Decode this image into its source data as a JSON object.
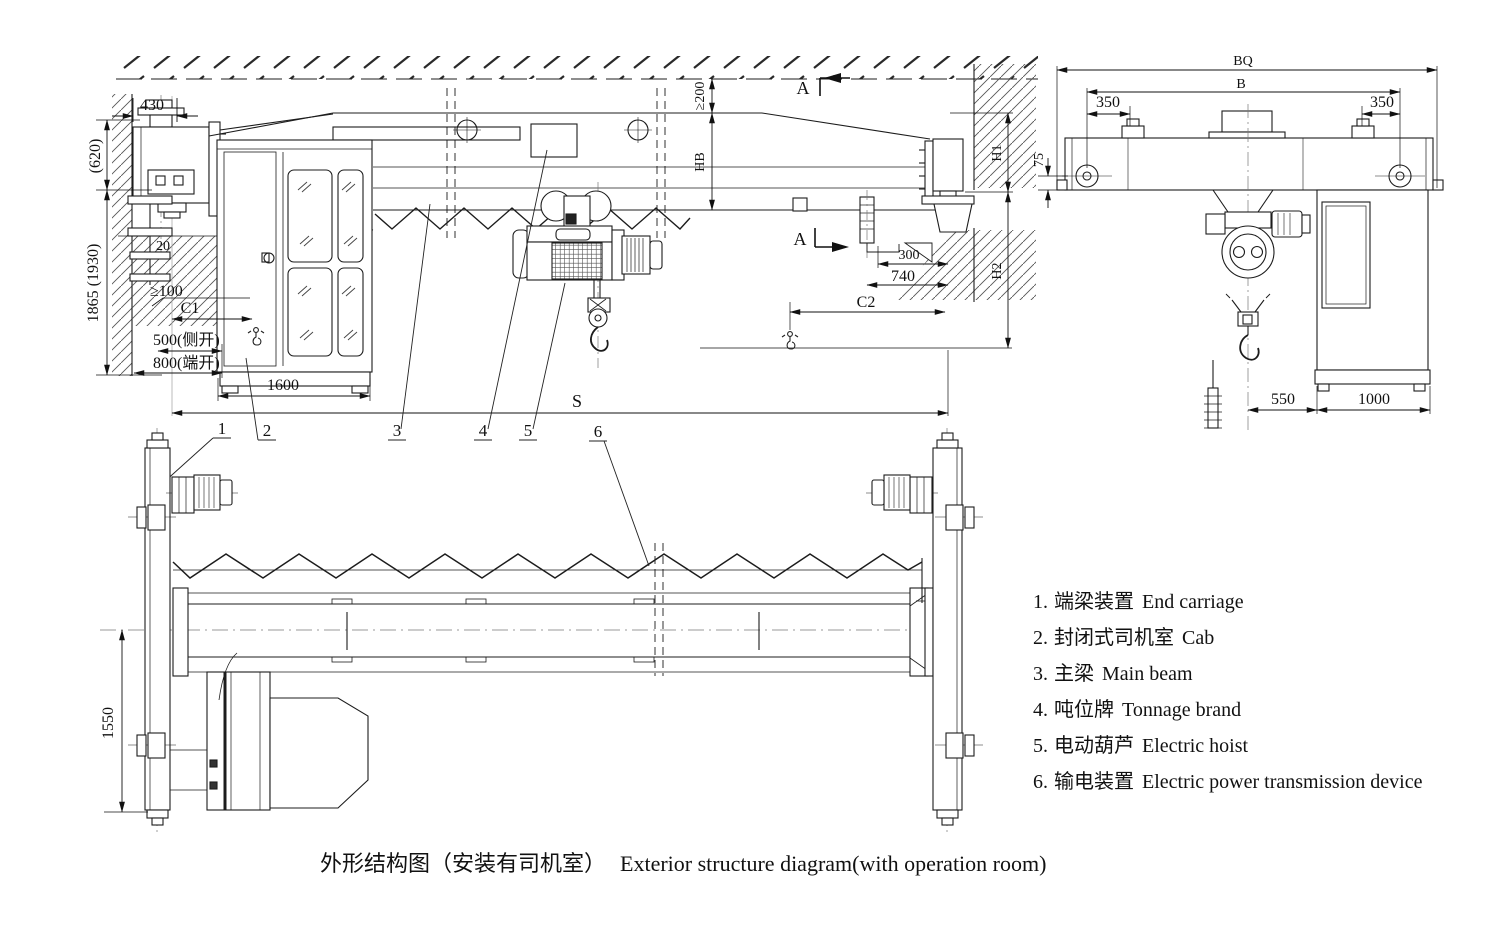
{
  "page": {
    "background": "#ffffff",
    "line_color": "#1c1c1c"
  },
  "caption": {
    "zh": "外形结构图（安装有司机室）",
    "en": "Exterior structure diagram(with operation room)"
  },
  "legend": {
    "items": [
      {
        "num": "1.",
        "zh": "端梁装置",
        "en": "End carriage"
      },
      {
        "num": "2.",
        "zh": "封闭式司机室",
        "en": "Cab"
      },
      {
        "num": "3.",
        "zh": "主梁",
        "en": "Main beam"
      },
      {
        "num": "4.",
        "zh": "吨位牌",
        "en": "Tonnage brand"
      },
      {
        "num": "5.",
        "zh": "电动葫芦",
        "en": "Electric hoist"
      },
      {
        "num": "6.",
        "zh": "输电装置",
        "en": "Electric power transmission device"
      }
    ]
  },
  "front_view": {
    "section_marker": "A",
    "dims": {
      "d430": "430",
      "d620": "(620)",
      "d1865": "1865 (1930)",
      "d20": "20",
      "ge100": "≥100",
      "c1": "C1",
      "d500_side": "500(侧开)",
      "d800_end": "800(端开)",
      "d1600": "1600",
      "ge200": "≥200",
      "hb": "HB",
      "d300": "300",
      "d740": "740",
      "c2": "C2",
      "h1": "H1",
      "h2": "H2",
      "s": "S"
    },
    "callouts": [
      "1",
      "2",
      "3",
      "4",
      "5",
      "6"
    ]
  },
  "side_view": {
    "dims": {
      "bq": "BQ",
      "b": "B",
      "d350_left": "350",
      "d350_right": "350",
      "d75": "75",
      "d550": "550",
      "d1000": "1000"
    }
  },
  "plan_view": {
    "dims": {
      "d1550": "1550"
    }
  }
}
